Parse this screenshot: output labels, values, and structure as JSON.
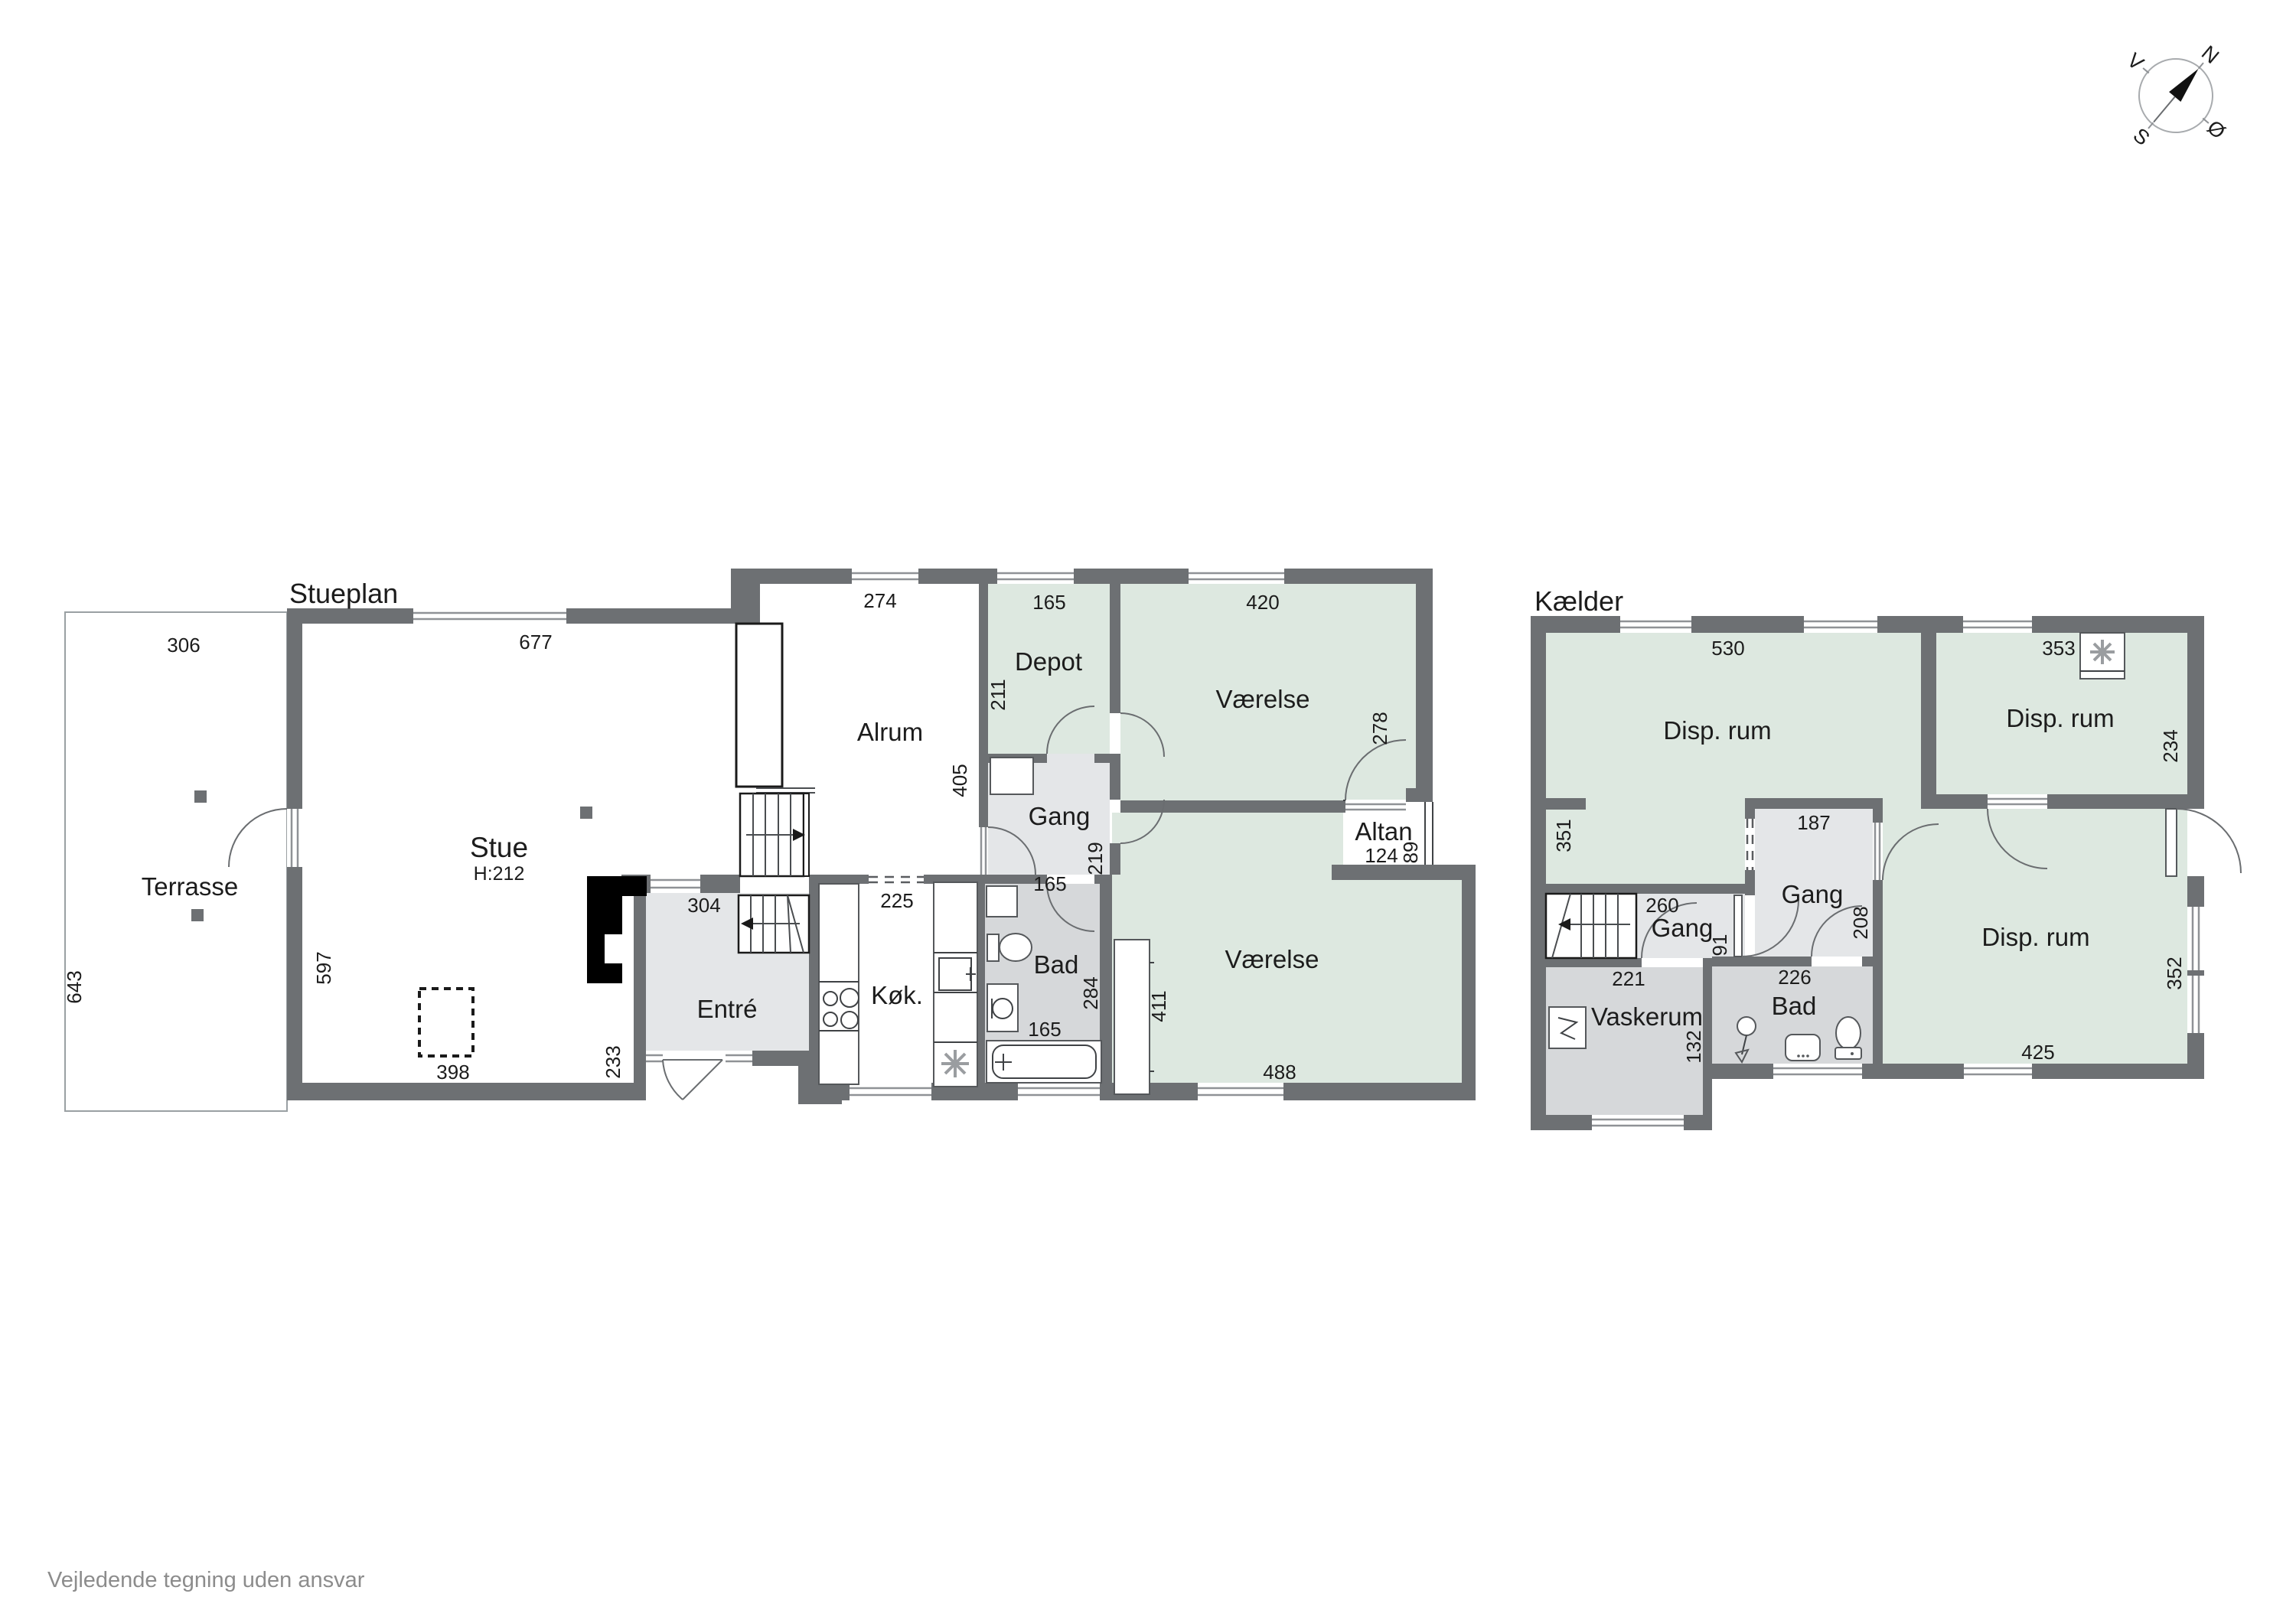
{
  "page": {
    "footer": "Vejledende tegning uden ansvar"
  },
  "compass": {
    "north": "N",
    "east": "Ø",
    "south": "S",
    "west": "V"
  },
  "stueplan": {
    "title": "Stueplan",
    "rooms": {
      "terrasse": "Terrasse",
      "stue": "Stue",
      "stue_ceiling": "H:212",
      "alrum": "Alrum",
      "entre": "Entré",
      "koekken": "Køk.",
      "bad": "Bad",
      "depot": "Depot",
      "gang": "Gang",
      "vaerelse_top": "Værelse",
      "vaerelse_bottom": "Værelse",
      "altan": "Altan"
    },
    "dims": {
      "terrasse_width": "306",
      "terrasse_depth": "643",
      "stue_width": "677",
      "stue_wall": "597",
      "stue_chimney": "398",
      "alrum_width": "274",
      "alrum_depth": "405",
      "alrum_opening": "225",
      "entre_width": "304",
      "entre_depth": "233",
      "depot_width": "165",
      "depot_depth": "211",
      "gang_depth": "219",
      "gang_width": "165",
      "bad_width": "165",
      "bad_depth": "284",
      "vaerelse_top_width": "420",
      "vaerelse_top_depth": "278",
      "altan_width": "124",
      "altan_depth": "89",
      "vaerelse_bottom_width": "488",
      "vaerelse_bottom_depth": "411"
    }
  },
  "kaelder": {
    "title": "Kælder",
    "rooms": {
      "disp_nw": "Disp. rum",
      "disp_ne": "Disp. rum",
      "disp_s": "Disp. rum",
      "gang_n": "Gang",
      "gang_w": "Gang",
      "vaskerum": "Vaskerum",
      "bad": "Bad"
    },
    "dims": {
      "disp_nw_width": "530",
      "disp_nw_wall": "351",
      "disp_ne_width": "353",
      "disp_ne_depth": "234",
      "gang_n_width": "187",
      "gang_n_depth": "208",
      "gang_w_width": "260",
      "gang_w_depth": "91",
      "vaskerum_width": "221",
      "vaskerum_depth": "132",
      "bad_width": "226",
      "disp_s_width": "425",
      "disp_s_depth": "352"
    }
  }
}
